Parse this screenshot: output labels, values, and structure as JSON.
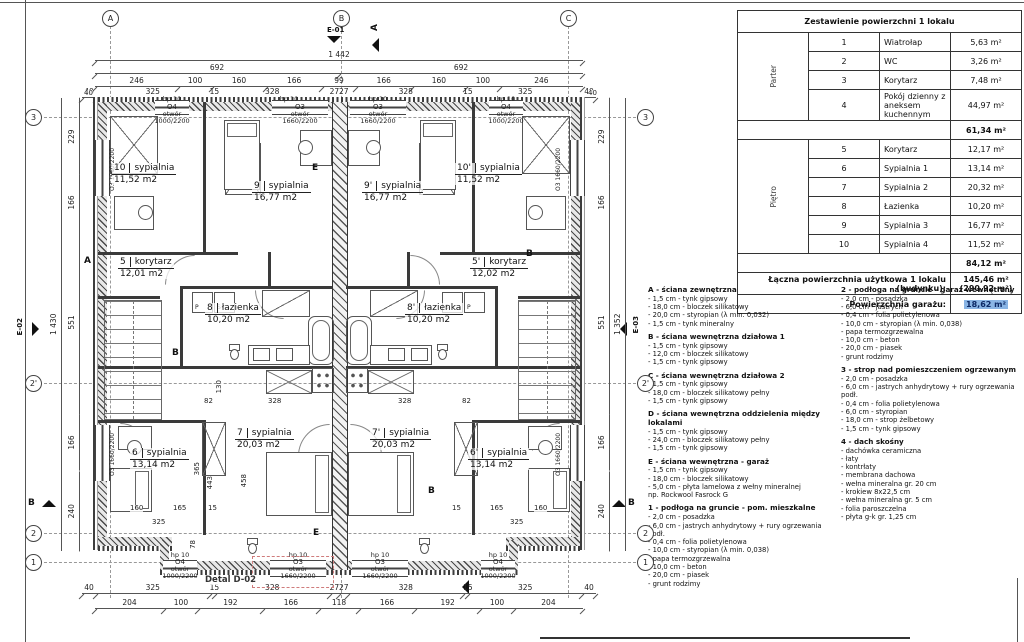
{
  "table": {
    "title": "Zestawienie powierzchni 1 lokalu",
    "groups": [
      {
        "label": "Parter"
      },
      {
        "label": "Piętro"
      }
    ],
    "rows": [
      {
        "no": "1",
        "name": "Wiatrołap",
        "area": "5,63 m²"
      },
      {
        "no": "2",
        "name": "WC",
        "area": "3,26 m²"
      },
      {
        "no": "3",
        "name": "Korytarz",
        "area": "7,48 m²"
      },
      {
        "no": "4",
        "name": "Pokój dzienny z aneksem kuchennym",
        "area": "44,97 m²"
      },
      {
        "no": "5",
        "name": "Korytarz",
        "area": "12,17 m²"
      },
      {
        "no": "6",
        "name": "Sypialnia 1",
        "area": "13,14 m²"
      },
      {
        "no": "7",
        "name": "Sypialnia 2",
        "area": "20,32 m²"
      },
      {
        "no": "8",
        "name": "Łazienka",
        "area": "10,20 m²"
      },
      {
        "no": "9",
        "name": "Sypialnia 3",
        "area": "16,77 m²"
      },
      {
        "no": "10",
        "name": "Sypialnia 4",
        "area": "11,52 m²"
      }
    ],
    "subtotal_parter": "61,34 m²",
    "subtotal_pietro": "84,12 m²",
    "total_label": "Łączna powierzchnia użytkowa 1 lokalu (budynku):",
    "total_value": "145,46 m²",
    "total_value2": "(290,92 m²)",
    "garage_label": "Powierzchnia garażu:",
    "garage_value": "18,62 m²"
  },
  "legend": {
    "left": [
      {
        "title": "A - ściana zewnętrzna",
        "body": "- 1,5 cm - tynk gipsowy\n- 18,0 cm - bloczek silikatowy\n- 20,0 cm - styropian (λ min. 0,032)\n- 1,5 cm - tynk mineralny"
      },
      {
        "title": "B - ściana wewnętrzna działowa 1",
        "body": "- 1,5 cm - tynk gipsowy\n- 12,0 cm - bloczek silikatowy\n- 1,5 cm - tynk gipsowy"
      },
      {
        "title": "C - ściana wewnętrzna działowa 2",
        "body": "- 1,5 cm - tynk gipsowy\n- 18,0 cm - bloczek silikatowy pełny\n- 1,5 cm - tynk gipsowy"
      },
      {
        "title": "D - ściana wewnętrzna oddzielenia między lokalami",
        "body": "- 1,5 cm - tynk gipsowy\n- 24,0 cm - bloczek silikatowy pełny\n- 1,5 cm - tynk gipsowy"
      },
      {
        "title": "E - ściana wewnętrzna - garaż",
        "body": "- 1,5 cm - tynk gipsowy\n- 18,0 cm - bloczek silikatowy\n- 5,0 cm - płyta lamelowa z wełny mineralnej\n        np. Rockwool Fasrock G"
      },
      {
        "title": "1 - podłoga na gruncie - pom. mieszkalne",
        "body": "- 2,0 cm - posadzka\n- 6,0 cm - jastrych anhydrytowy + rury ogrzewania podł.\n- 0,4 cm - folia polietylenowa\n- 10,0 cm - styropian (λ min. 0,038)\n- papa termozgrzewalna\n- 10,0 cm - beton\n- 20,0 cm - piasek\n- grunt rodzimy"
      }
    ],
    "right": [
      {
        "title": "2 - podłoga na gruncie - garaż wewnętrzny",
        "body": "- 2,0 cm - posadzka\n- 6,0 cm - jastrych\n- 0,4 cm - folia polietylenowa\n- 10,0 cm - styropian (λ min. 0,038)\n- papa termozgrzewalna\n- 10,0 cm - beton\n- 20,0 cm - piasek\n- grunt rodzimy"
      },
      {
        "title": "3 - strop nad pomieszczeniem ogrzewanym",
        "body": "- 2,0 cm - posadzka\n- 6,0 cm - jastrych anhydrytowy + rury ogrzewania podł.\n- 0,4 cm - folia polietylenowa\n- 6,0 cm - styropian\n- 18,0 cm - strop żelbetowy\n- 1,5 cm - tynk gipsowy"
      },
      {
        "title": "4 - dach skośny",
        "body": "- dachówka ceramiczna\n- łaty\n- kontrłaty\n- membrana dachowa\n- wełna mineralna gr. 20 cm\n- krokiew 8x22,5 cm\n- wełna mineralna gr. 5 cm\n- folia paroszczelna\n- płyta g-k gr. 1,25 cm"
      }
    ]
  },
  "plan": {
    "axes_top": [
      "A",
      "B",
      "C"
    ],
    "axes_side": [
      "3",
      "2'",
      "2",
      "1"
    ],
    "markers": {
      "e01": "E-01",
      "e02": "E-02",
      "e03": "E-03",
      "sectionA": "A",
      "sectionB": "B"
    },
    "dims": {
      "top_overall": "1 442",
      "top2": [
        "692",
        "692"
      ],
      "top3": [
        "246",
        "100",
        "160",
        "166",
        "99",
        "166",
        "160",
        "100",
        "246"
      ],
      "top4": [
        "40",
        "325",
        "15",
        "328",
        "27",
        "27",
        "328",
        "15",
        "325",
        "40"
      ],
      "bottom1": [
        "40",
        "325",
        "15",
        "328",
        "27",
        "27",
        "328",
        "15",
        "325",
        "40"
      ],
      "bottom2": [
        "204",
        "100",
        "192",
        "166",
        "118",
        "166",
        "192",
        "100",
        "204"
      ],
      "left_overall": "1 430",
      "right_overall": "1 352",
      "side_segments": [
        "229",
        "166",
        "551",
        "166",
        "240"
      ],
      "edge_offset": "40"
    },
    "interior_dims": [
      "82",
      "328",
      "328",
      "82",
      "130",
      "365",
      "443",
      "458",
      "78",
      "160",
      "165",
      "15",
      "325",
      "15",
      "165",
      "160",
      "325"
    ],
    "windows": {
      "hp": "hp 10",
      "o4": {
        "code": "O4",
        "line1": "otwór",
        "line2": "1000/2200"
      },
      "o3": {
        "code": "O3",
        "line1": "otwór",
        "line2": "1660/2200"
      }
    },
    "rooms": [
      {
        "num": "10",
        "name": "sypialnia",
        "area": "11,52 m2"
      },
      {
        "num": "9",
        "name": "sypialnia",
        "area": "16,77 m2"
      },
      {
        "num": "5",
        "name": "korytarz",
        "area": "12,01 m2"
      },
      {
        "num": "8",
        "name": "łazienka",
        "area": "10,20 m2"
      },
      {
        "num": "7",
        "name": "sypialnia",
        "area": "20,03 m2"
      },
      {
        "num": "6",
        "name": "sypialnia",
        "area": "13,14 m2"
      },
      {
        "num": "10'",
        "name": "sypialnia",
        "area": "11,52 m2"
      },
      {
        "num": "9'",
        "name": "sypialnia",
        "area": "16,77 m2"
      },
      {
        "num": "5'",
        "name": "korytarz",
        "area": "12,02 m2"
      },
      {
        "num": "8'",
        "name": "łazienka",
        "area": "10,20 m2"
      },
      {
        "num": "7'",
        "name": "sypialnia",
        "area": "20,03 m2"
      },
      {
        "num": "6'",
        "name": "sypialnia",
        "area": "13,14 m2"
      }
    ],
    "wall_letters": [
      "A",
      "B",
      "E",
      "B",
      "B",
      "E"
    ],
    "detail_label": "Detal D-02"
  }
}
